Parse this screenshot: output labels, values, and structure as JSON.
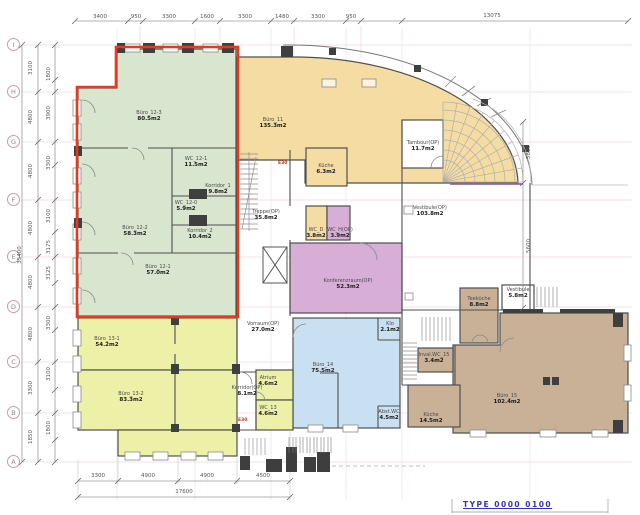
{
  "drawing": {
    "type": "architectural-floor-plan",
    "link_text": "TYPE 0000 0100"
  },
  "colors": {
    "office_green": "#d8e6cf",
    "office_orange": "#f5dca3",
    "office_yellow": "#edf0a7",
    "office_blue": "#c9e0f2",
    "conference_purple": "#d6aed6",
    "office_brown": "#c9b197",
    "highlight_red": "#e6391d",
    "grid_pink": "#f0d8e3",
    "wall_gray": "#4f4f4f",
    "link_blue": "#3434bb"
  },
  "grid_letters": [
    {
      "label": "I",
      "y": 45
    },
    {
      "label": "H",
      "y": 92
    },
    {
      "label": "G",
      "y": 142
    },
    {
      "label": "F",
      "y": 200
    },
    {
      "label": "E",
      "y": 257
    },
    {
      "label": "D",
      "y": 307
    },
    {
      "label": "C",
      "y": 362
    },
    {
      "label": "B",
      "y": 413
    },
    {
      "label": "A",
      "y": 462
    }
  ],
  "rooms": [
    {
      "name": "Büro_12-3",
      "area": "80.5m2",
      "x": 149,
      "y": 110
    },
    {
      "name": "WC_12-1",
      "area": "11.5m2",
      "x": 196,
      "y": 156
    },
    {
      "name": "Korridor_1",
      "area": "9.8m2",
      "x": 218,
      "y": 183
    },
    {
      "name": "WC_12-0",
      "area": "5.9m2",
      "x": 186,
      "y": 200
    },
    {
      "name": "Büro_12-2",
      "area": "58.3m2",
      "x": 135,
      "y": 225
    },
    {
      "name": "Korridor_2",
      "area": "10.4m2",
      "x": 200,
      "y": 228
    },
    {
      "name": "Büro_12-1",
      "area": "57.0m2",
      "x": 158,
      "y": 264
    },
    {
      "name": "Büro_11",
      "area": "135.3m2",
      "x": 273,
      "y": 117
    },
    {
      "name": "Küche",
      "area": "6.3m2",
      "x": 326,
      "y": 163
    },
    {
      "name": "WC_D",
      "area": "3.8m2",
      "x": 316,
      "y": 227
    },
    {
      "name": "WC_H(OP)",
      "area": "3.9m2",
      "x": 340,
      "y": 227
    },
    {
      "name": "Tambour(OP)",
      "area": "11.7m2",
      "x": 423,
      "y": 140
    },
    {
      "name": "Treppe(OP)",
      "area": "35.8m2",
      "x": 266,
      "y": 209
    },
    {
      "name": "Vestibule(OP)",
      "area": "103.8m2",
      "x": 430,
      "y": 205
    },
    {
      "name": "Konferenzraum(OP)",
      "area": "52.3m2",
      "x": 348,
      "y": 278
    },
    {
      "name": "Vorraum(OP)",
      "area": "27.0m2",
      "x": 263,
      "y": 321
    },
    {
      "name": "Büro_13-1",
      "area": "54.2m2",
      "x": 107,
      "y": 336
    },
    {
      "name": "Büro_13-2",
      "area": "83.3m2",
      "x": 131,
      "y": 391
    },
    {
      "name": "Korridor(OP)",
      "area": "8.1m2",
      "x": 247,
      "y": 385
    },
    {
      "name": "Atrium",
      "area": "4.6m2",
      "x": 268,
      "y": 375
    },
    {
      "name": "WC_13",
      "area": "4.6m2",
      "x": 268,
      "y": 405
    },
    {
      "name": "Büro_14",
      "area": "75.5m2",
      "x": 323,
      "y": 362
    },
    {
      "name": "Klo",
      "area": "2.1m2",
      "x": 390,
      "y": 321
    },
    {
      "name": "Abst.WC",
      "area": "4.5m2",
      "x": 389,
      "y": 409
    },
    {
      "name": "Teeküche",
      "area": "8.8m2",
      "x": 479,
      "y": 296
    },
    {
      "name": "Vestibule",
      "area": "5.8m2",
      "x": 518,
      "y": 287
    },
    {
      "name": "Inval.WC_15",
      "area": "3.4m2",
      "x": 434,
      "y": 352
    },
    {
      "name": "Küche",
      "area": "14.5m2",
      "x": 431,
      "y": 412
    },
    {
      "name": "Büro_15",
      "area": "102.4m2",
      "x": 507,
      "y": 393
    }
  ],
  "door_labels": [
    {
      "text": "E30",
      "x": 278,
      "y": 161
    },
    {
      "text": "E30",
      "x": 238,
      "y": 418
    }
  ],
  "dimensions": {
    "top": [
      {
        "text": "3400",
        "x": 100,
        "y": 14
      },
      {
        "text": "950",
        "x": 136,
        "y": 14
      },
      {
        "text": "3300",
        "x": 169,
        "y": 14
      },
      {
        "text": "1600",
        "x": 207,
        "y": 14
      },
      {
        "text": "3300",
        "x": 245,
        "y": 14
      },
      {
        "text": "1480",
        "x": 282,
        "y": 14
      },
      {
        "text": "3300",
        "x": 318,
        "y": 14
      },
      {
        "text": "950",
        "x": 351,
        "y": 14
      },
      {
        "text": "13075",
        "x": 492,
        "y": 13
      }
    ],
    "bottom": [
      {
        "text": "3300",
        "x": 98,
        "y": 473
      },
      {
        "text": "4900",
        "x": 148,
        "y": 473
      },
      {
        "text": "4900",
        "x": 207,
        "y": 473
      },
      {
        "text": "4500",
        "x": 263,
        "y": 473
      },
      {
        "text": "17600",
        "x": 184,
        "y": 489
      }
    ],
    "left": [
      {
        "text": "3100",
        "x": 31,
        "y": 68,
        "rot": true
      },
      {
        "text": "4800",
        "x": 31,
        "y": 117,
        "rot": true
      },
      {
        "text": "4800",
        "x": 31,
        "y": 171,
        "rot": true
      },
      {
        "text": "4800",
        "x": 31,
        "y": 228,
        "rot": true
      },
      {
        "text": "4800",
        "x": 31,
        "y": 282,
        "rot": true
      },
      {
        "text": "4800",
        "x": 31,
        "y": 334,
        "rot": true
      },
      {
        "text": "3300",
        "x": 31,
        "y": 388,
        "rot": true
      },
      {
        "text": "1850",
        "x": 31,
        "y": 437,
        "rot": true
      },
      {
        "text": "1800",
        "x": 49,
        "y": 74,
        "rot": true
      },
      {
        "text": "3900",
        "x": 49,
        "y": 113,
        "rot": true
      },
      {
        "text": "3300",
        "x": 49,
        "y": 163,
        "rot": true
      },
      {
        "text": "3100",
        "x": 49,
        "y": 216,
        "rot": true
      },
      {
        "text": "3175",
        "x": 49,
        "y": 247,
        "rot": true
      },
      {
        "text": "3125",
        "x": 49,
        "y": 273,
        "rot": true
      },
      {
        "text": "3300",
        "x": 49,
        "y": 323,
        "rot": true
      },
      {
        "text": "3100",
        "x": 49,
        "y": 374,
        "rot": true
      },
      {
        "text": "1800",
        "x": 49,
        "y": 428,
        "rot": true
      },
      {
        "text": "35400",
        "x": 20,
        "y": 255,
        "rot": true
      }
    ],
    "right": [
      {
        "text": "5800",
        "x": 529,
        "y": 152,
        "rot": true
      },
      {
        "text": "5600",
        "x": 529,
        "y": 246,
        "rot": true
      }
    ]
  }
}
